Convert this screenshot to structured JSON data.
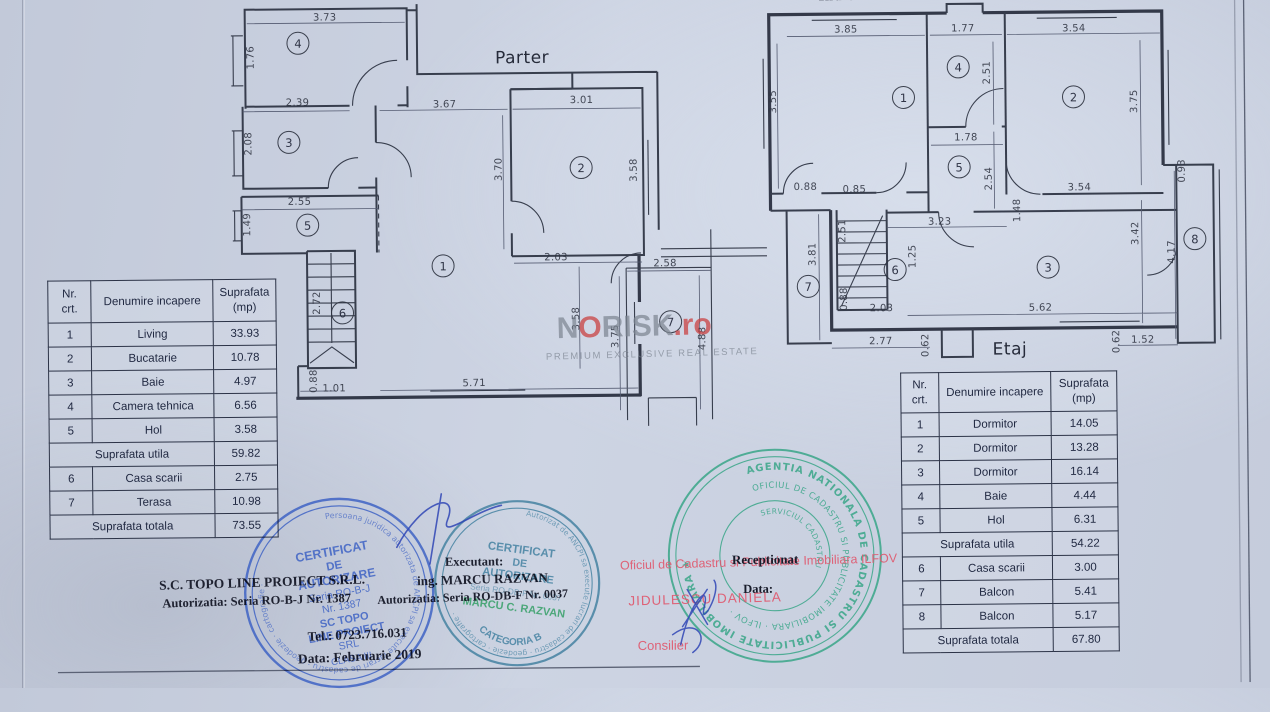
{
  "page": {
    "title_fragment": "Individuala"
  },
  "watermark": {
    "pre": "N",
    "o": "O",
    "rest": "RISK",
    "tld": ".ro",
    "tagline": "PREMIUM EXCLUSIVE REAL ESTATE"
  },
  "parter": {
    "label": "Parter",
    "rooms": [
      "1",
      "2",
      "3",
      "4",
      "5",
      "6",
      "7"
    ],
    "dims": [
      "3.73",
      "1.76",
      "2.39",
      "2.08",
      "2.55",
      "1.49",
      "2.72",
      "3.67",
      "3.01",
      "3.70",
      "3.58",
      "2.03",
      "2.58",
      "3.58",
      "3.75",
      "4.88",
      "1.01",
      "0.88",
      "5.71"
    ]
  },
  "etaj": {
    "label": "Etaj",
    "rooms": [
      "1",
      "2",
      "3",
      "4",
      "5",
      "6",
      "7",
      "8"
    ],
    "dims": [
      "3.85",
      "1.77",
      "3.54",
      "3.55",
      "2.51",
      "3.75",
      "1.78",
      "2.54",
      "0.88",
      "0.85",
      "3.54",
      "0.93",
      "3.23",
      "1.48",
      "2.51",
      "3.81",
      "1.25",
      "0.88",
      "2.03",
      "3.42",
      "4.17",
      "5.62",
      "2.77",
      "0.62",
      "0.62",
      "1.52"
    ]
  },
  "parter_table": {
    "header": {
      "nr1": "Nr.",
      "nr2": "crt.",
      "name": "Denumire incapere",
      "area1": "Suprafata",
      "area2": "(mp)"
    },
    "rows": [
      {
        "nr": "1",
        "name": "Living",
        "area": "33.93"
      },
      {
        "nr": "2",
        "name": "Bucatarie",
        "area": "10.78"
      },
      {
        "nr": "3",
        "name": "Baie",
        "area": "4.97"
      },
      {
        "nr": "4",
        "name": "Camera tehnica",
        "area": "6.56"
      },
      {
        "nr": "5",
        "name": "Hol",
        "area": "3.58"
      }
    ],
    "subtotal": {
      "label": "Suprafata utila",
      "area": "59.82"
    },
    "rows2": [
      {
        "nr": "6",
        "name": "Casa scarii",
        "area": "2.75"
      },
      {
        "nr": "7",
        "name": "Terasa",
        "area": "10.98"
      }
    ],
    "total": {
      "label": "Suprafata totala",
      "area": "73.55"
    }
  },
  "etaj_table": {
    "header": {
      "nr1": "Nr.",
      "nr2": "crt.",
      "name": "Denumire incapere",
      "area1": "Suprafata",
      "area2": "(mp)"
    },
    "rows": [
      {
        "nr": "1",
        "name": "Dormitor",
        "area": "14.05"
      },
      {
        "nr": "2",
        "name": "Dormitor",
        "area": "13.28"
      },
      {
        "nr": "3",
        "name": "Dormitor",
        "area": "16.14"
      },
      {
        "nr": "4",
        "name": "Baie",
        "area": "4.44"
      },
      {
        "nr": "5",
        "name": "Hol",
        "area": "6.31"
      }
    ],
    "subtotal": {
      "label": "Suprafata utila",
      "area": "54.22"
    },
    "rows2": [
      {
        "nr": "6",
        "name": "Casa scarii",
        "area": "3.00"
      },
      {
        "nr": "7",
        "name": "Balcon",
        "area": "5.41"
      },
      {
        "nr": "8",
        "name": "Balcon",
        "area": "5.17"
      }
    ],
    "total": {
      "label": "Suprafata totala",
      "area": "67.80"
    }
  },
  "firm": {
    "line1": "S.C. TOPO LINE PROIECT S.R.L.",
    "line2": "Autorizatia: Seria RO-B-J Nr. 1387",
    "line3": "Tel.: 0723.716.031",
    "line4": "Data: Februarie 2019"
  },
  "executant": {
    "line1": "Executant:",
    "line2": "ing. MARCU RAZVAN",
    "line3": "Autorizatia: Seria RO-DB-F Nr. 0037"
  },
  "reception": {
    "receptionat": "Receptionat",
    "data_label": "Data:",
    "office": "Oficiul de Cadastru si Publicitate Imobiliara ILFOV",
    "name": "JIDULESCU DANIELA",
    "role": "Consilier"
  },
  "stamp_topo": {
    "ring": "Persoana juridica autorizata de ANCPI sa execute lucrari de cadastru · geodezie · cartografie ·",
    "l1": "CERTIFICAT",
    "l2": "DE",
    "l3": "AUTORIZARE",
    "l4": "Seria RO-B-J",
    "l5": "Nr. 1387",
    "l6": "SC TOPO",
    "l7": "LINE PROIECT",
    "l8": "SRL",
    "l9": "CLASA III"
  },
  "stamp_marcu": {
    "ring": "Autorizat de ANCPI sa execute lucrari de cadastru · geodezie · cartografie ·",
    "l1": "CERTIFICAT",
    "l2": "DE",
    "l3": "AUTORIZARE",
    "l4": "Seria RO-DB-F Nr. 0037",
    "l5": "MARCU C. RAZVAN",
    "l6": "CATEGORIA B"
  },
  "stamp_ocpi": {
    "ring_outer": "AGENTIA NATIONALA DE CADASTRU SI PUBLICITATE IMOBILIARA ★",
    "ring_inner": "OFICIUL DE CADASTRU SI PUBLICITATE IMOBILIARA · ILFOV ·",
    "center": "SERVICIUL CADASTRU"
  },
  "colors": {
    "stamp_blue": "#3e62c4",
    "stamp_teal": "#3f7f9f",
    "stamp_green_name": "#2f9e62",
    "stamp_ocpi_green": "#2fa382",
    "red_stamp": "#e0586e",
    "ink": "#23283a"
  }
}
